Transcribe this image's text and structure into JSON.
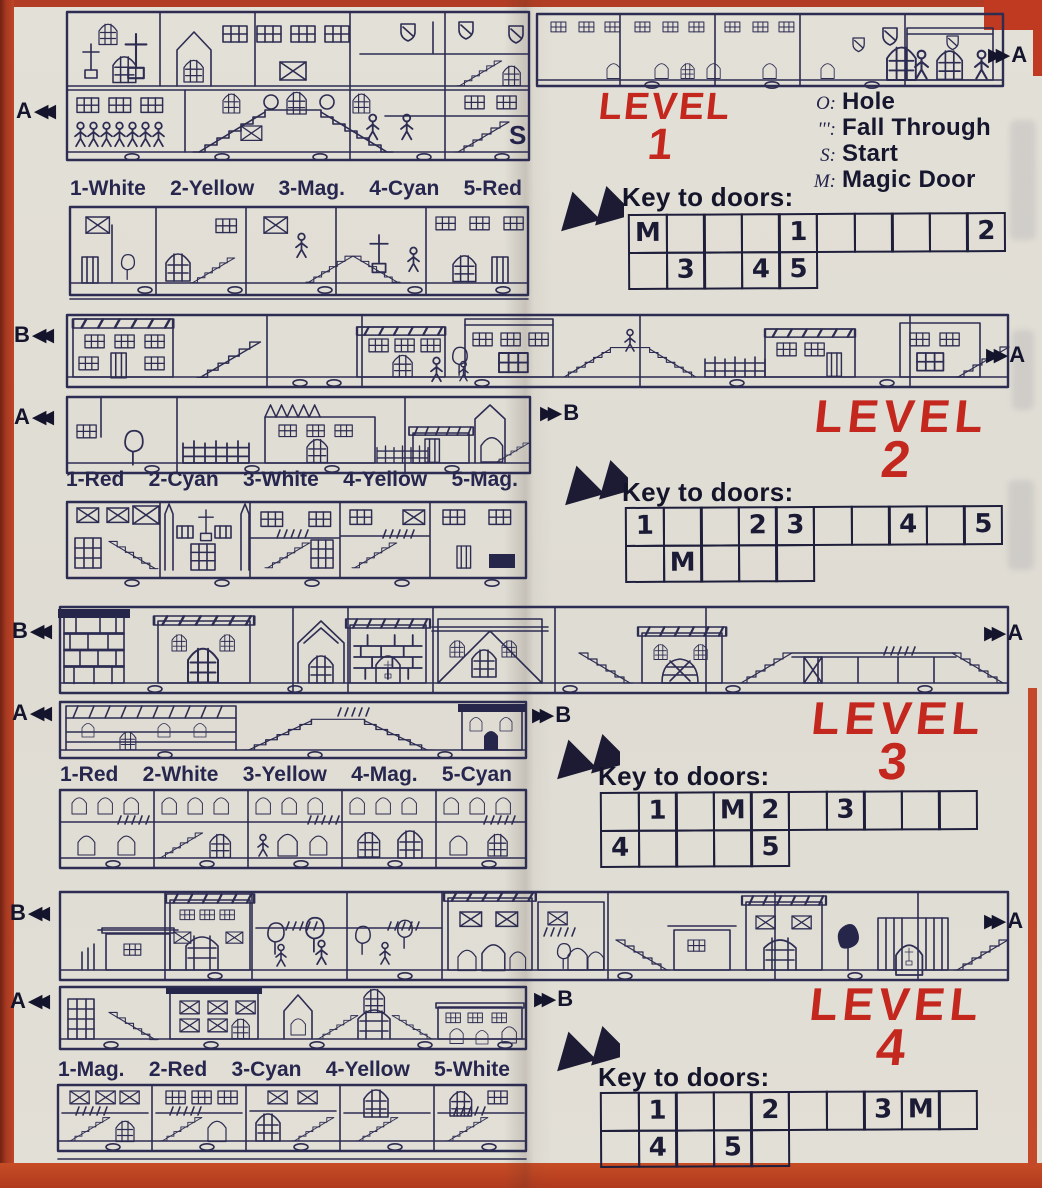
{
  "page": {
    "paper_color": "#e2dfd6",
    "ink_color": "#2d2c52",
    "accent_red": "#c3271e"
  },
  "icons": {
    "double_left_arrow": "◀◀",
    "double_right_arrow": "▶▶",
    "key_pointer": "pointer-down-left-arrow"
  },
  "legend": {
    "items": [
      {
        "symbol": "O:",
        "label": "Hole"
      },
      {
        "symbol": "''':",
        "label": "Fall Through"
      },
      {
        "symbol": "S:",
        "label": "Start"
      },
      {
        "symbol": "M:",
        "label": "Magic Door"
      }
    ]
  },
  "levels": [
    {
      "title_word": "LEVEL",
      "title_number": "1",
      "key_heading": "Key to doors:",
      "color_key": [
        "1-White",
        "2-Yellow",
        "3-Mag.",
        "4-Cyan",
        "5-Red"
      ],
      "door_grid_row1": [
        "M",
        "",
        "",
        "",
        "1",
        "",
        "",
        "",
        "",
        "2"
      ],
      "door_grid_row2": [
        "",
        "3",
        "",
        "4",
        "5"
      ],
      "start_marker": "S",
      "markers": {
        "left": "A",
        "right": "A"
      }
    },
    {
      "title_word": "LEVEL",
      "title_number": "2",
      "key_heading": "Key to doors:",
      "color_key": [
        "1-Red",
        "2-Cyan",
        "3-White",
        "4-Yellow",
        "5-Mag."
      ],
      "door_grid_row1": [
        "1",
        "",
        "",
        "2",
        "3",
        "",
        "",
        "4",
        "",
        "5"
      ],
      "door_grid_row2": [
        "",
        "M",
        "",
        "",
        ""
      ],
      "markers": {
        "upper_left": "B",
        "upper_right": "A",
        "lower_left": "A",
        "lower_right": "B"
      }
    },
    {
      "title_word": "LEVEL",
      "title_number": "3",
      "key_heading": "Key to doors:",
      "color_key": [
        "1-Red",
        "2-White",
        "3-Yellow",
        "4-Mag.",
        "5-Cyan"
      ],
      "door_grid_row1": [
        "",
        "1",
        "",
        "M",
        "2",
        "",
        "3",
        "",
        "",
        ""
      ],
      "door_grid_row2": [
        "4",
        "",
        "",
        "",
        "5"
      ],
      "markers": {
        "upper_left": "B",
        "upper_right": "A",
        "lower_left": "A",
        "lower_right": "B"
      }
    },
    {
      "title_word": "LEVEL",
      "title_number": "4",
      "key_heading": "Key to doors:",
      "color_key": [
        "1-Mag.",
        "2-Red",
        "3-Cyan",
        "4-Yellow",
        "5-White"
      ],
      "door_grid_row1": [
        "",
        "1",
        "",
        "",
        "2",
        "",
        "",
        "3",
        "M",
        ""
      ],
      "door_grid_row2": [
        "",
        "4",
        "",
        "5",
        ""
      ],
      "markers": {
        "upper_left": "B",
        "upper_right": "A",
        "lower_left": "A",
        "lower_right": "B"
      }
    }
  ]
}
